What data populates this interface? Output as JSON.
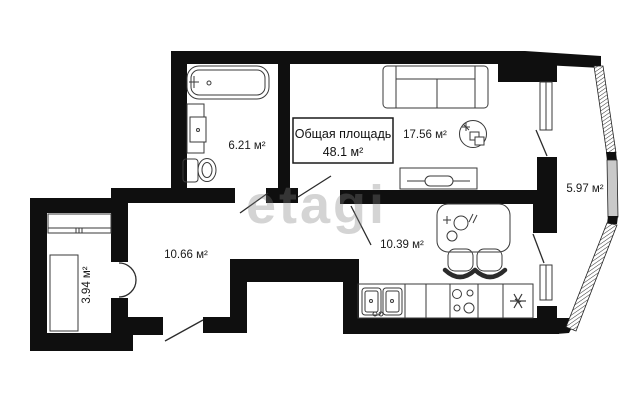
{
  "plan": {
    "type": "apartment-floor-plan",
    "total": {
      "title": "Общая площадь",
      "value": "48.1 м²"
    },
    "rooms": {
      "bathroom": {
        "label": "6.21 м²"
      },
      "living": {
        "label": "17.56 м²"
      },
      "balcony": {
        "label": "5.97 м²"
      },
      "hallway": {
        "label": "10.66 м²"
      },
      "kitchen": {
        "label": "10.39 м²"
      },
      "wardrobe": {
        "label": "3.94 м²"
      }
    },
    "fixtures": [
      "bathtub",
      "washbasin",
      "toilet",
      "sofa",
      "coffee-table",
      "tv-stand",
      "dining-table",
      "chairs",
      "kitchen-sink",
      "stove",
      "fridge",
      "wardrobe-shelf",
      "wardrobe-cabinet"
    ],
    "watermark": {
      "text": "etagi"
    },
    "colors": {
      "wall": "#0f0f0f",
      "background": "#ffffff",
      "line": "#3a3a3a",
      "glazing_fill": "#c9c9c9",
      "watermark": "#d9d9d9"
    }
  }
}
